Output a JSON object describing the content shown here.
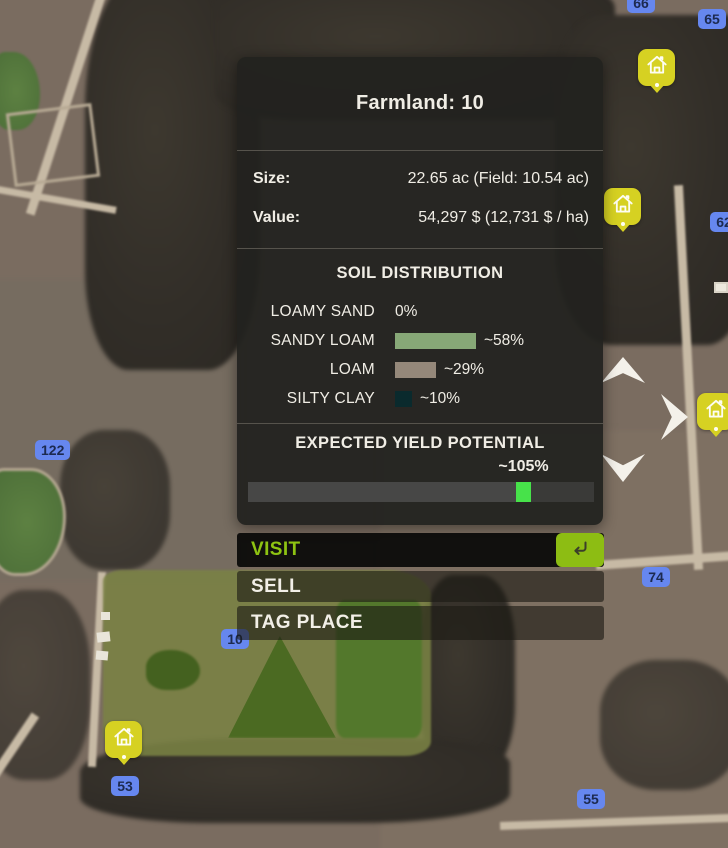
{
  "panel": {
    "title": "Farmland: 10",
    "size_label": "Size:",
    "size_value": "22.65 ac (Field: 10.54 ac)",
    "value_label": "Value:",
    "value_value": "54,297 $ (12,731 $ / ha)",
    "soil": {
      "title": "SOIL DISTRIBUTION",
      "rows": [
        {
          "label": "LOAMY SAND",
          "percent": "0%",
          "value_pct": 0,
          "bar_width_px": 0,
          "color": "none"
        },
        {
          "label": "SANDY LOAM",
          "percent": "~58%",
          "value_pct": 58,
          "bar_width_px": 81,
          "color": "#87a877"
        },
        {
          "label": "LOAM",
          "percent": "~29%",
          "value_pct": 29,
          "bar_width_px": 41,
          "color": "#95887a"
        },
        {
          "label": "SILTY CLAY",
          "percent": "~10%",
          "value_pct": 10,
          "bar_width_px": 17,
          "color": "#0a2a2d"
        }
      ]
    },
    "yield": {
      "title": "EXPECTED YIELD POTENTIAL",
      "value": "~105%",
      "value_pct": 105,
      "marker_fraction": 0.775
    }
  },
  "actions": {
    "visit": "VISIT",
    "sell": "SELL",
    "tag": "TAG PLACE"
  },
  "map": {
    "badges": [
      {
        "label": "66"
      },
      {
        "label": "65"
      },
      {
        "label": "62"
      },
      {
        "label": "122"
      },
      {
        "label": "74"
      },
      {
        "label": "10"
      },
      {
        "label": "53"
      },
      {
        "label": "55"
      }
    ],
    "house_marker_count": 4
  },
  "colors": {
    "accent_green": "#8ec312",
    "key_green": "#8dbd13",
    "badge_blue": "#6687ef",
    "badge_text": "#1c2a50",
    "house_yellow": "#d6d122",
    "yield_marker_green": "#47e24a",
    "panel_bg": "rgba(34,34,31,0.94)"
  }
}
